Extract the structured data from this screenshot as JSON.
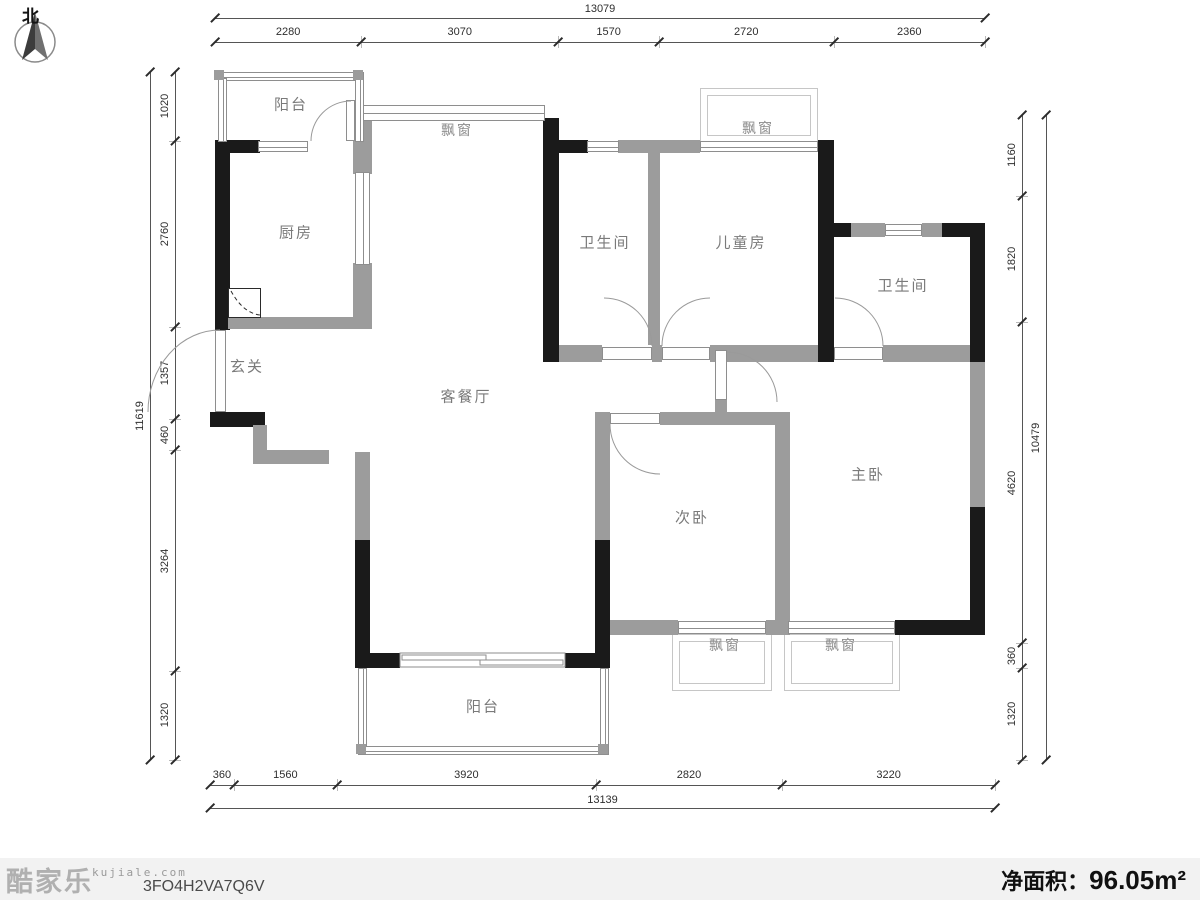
{
  "compass": {
    "label": "北"
  },
  "rooms": {
    "balcony_top": {
      "label": "阳台"
    },
    "kitchen": {
      "label": "厨房"
    },
    "bay_living": {
      "label": "飘窗"
    },
    "bathroom_1": {
      "label": "卫生间"
    },
    "kids_room": {
      "label": "儿童房"
    },
    "bay_kids": {
      "label": "飘窗"
    },
    "bathroom_2": {
      "label": "卫生间"
    },
    "entry": {
      "label": "玄关"
    },
    "living_dining": {
      "label": "客餐厅"
    },
    "second_bedroom": {
      "label": "次卧"
    },
    "master_bedroom": {
      "label": "主卧"
    },
    "bay_second": {
      "label": "飘窗"
    },
    "bay_master": {
      "label": "飘窗"
    },
    "balcony_bottom": {
      "label": "阳台"
    }
  },
  "dimensions": {
    "top": {
      "overall": "13079",
      "segments": [
        "2280",
        "3070",
        "1570",
        "2720",
        "2360"
      ]
    },
    "bottom": {
      "overall": "13139",
      "segments": [
        "360",
        "1560",
        "3920",
        "2820",
        "3220"
      ]
    },
    "left": {
      "overall": "11619",
      "segments": [
        "1020",
        "2760",
        "1357",
        "460",
        "3264",
        "1320"
      ]
    },
    "right": {
      "overall": "10479",
      "segments": [
        "1160",
        "1820",
        "4620",
        "360",
        "1320"
      ]
    }
  },
  "footer": {
    "logo": "酷家乐",
    "logo_site": "kujiale.com",
    "plan_code": "3FO4H2VA7Q6V",
    "area_label": "净面积：",
    "area_value": "96.05m²"
  },
  "colors": {
    "wall_black": "#1a1a1a",
    "wall_gray": "#9c9c9c",
    "frame_light": "#c6c6c6",
    "dim_line": "#555555",
    "room_label": "#7a7a7a",
    "footer_bg": "#f2f2f2"
  }
}
